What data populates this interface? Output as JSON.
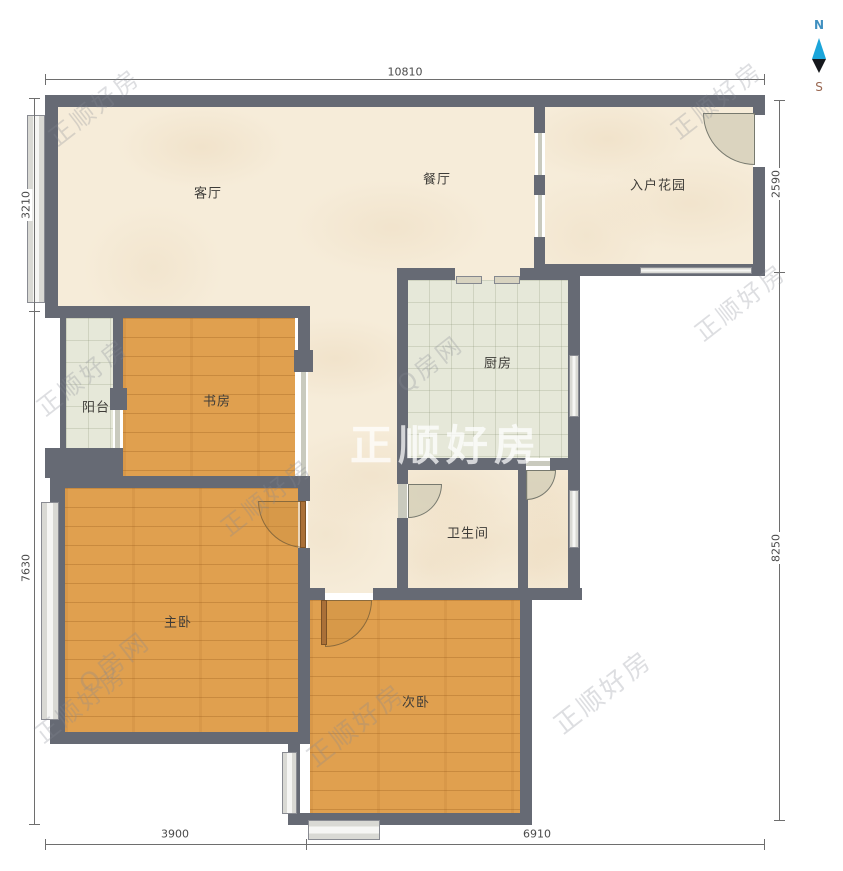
{
  "rooms": {
    "living": "客厅",
    "dining": "餐厅",
    "entry_garden": "入户花园",
    "balcony": "阳台",
    "study": "书房",
    "kitchen": "厨房",
    "bathroom": "卫生间",
    "master_bedroom": "主卧",
    "second_bedroom": "次卧"
  },
  "dims": {
    "top": "10810",
    "left_upper": "3210",
    "left_lower": "7630",
    "right_upper": "2590",
    "right_lower": "8250",
    "bottom_left": "3900",
    "bottom_right": "6910"
  },
  "compass": {
    "north": "N",
    "south": "S"
  },
  "watermark": {
    "brand": "正顺好房",
    "portal": "Q房网"
  },
  "colors": {
    "wall": "#666a74",
    "floor_cream": "#f6ecd9",
    "floor_wood": "#e0a04f",
    "floor_tile": "#e6e8d9",
    "compass_north_blue": "#1ba5da",
    "compass_south_dark": "#16181d",
    "north_label_blue": "#4090c0",
    "south_label_brown": "#9a6852"
  }
}
